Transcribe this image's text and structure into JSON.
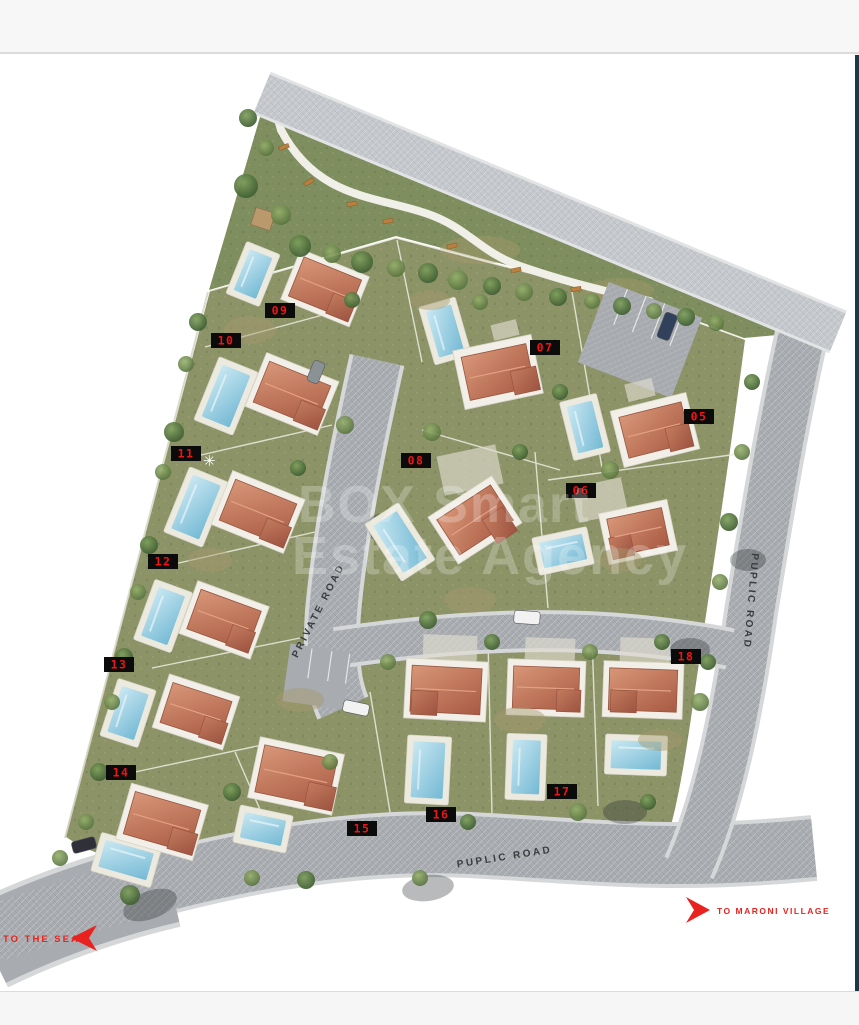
{
  "window": {
    "top_bar_color": "#f7f7f7",
    "bottom_bar_color": "#f6f6f6",
    "right_strip_color": "#143a4e",
    "canvas_color": "#ffffff"
  },
  "site_plan": {
    "watermark": {
      "line1": "BOX Smart",
      "line2": "Estate Agency"
    },
    "sun_symbol": "✳",
    "roads": [
      {
        "id": "private",
        "label": "PRIVATE ROAD"
      },
      {
        "id": "public-right",
        "label": "PUPLIC ROAD"
      },
      {
        "id": "public-bottom",
        "label": "PUPLIC ROAD"
      }
    ],
    "directions": [
      {
        "id": "to-sea",
        "label": "TO THE SEA",
        "arrow": "left"
      },
      {
        "id": "to-maroni",
        "label": "TO MARONI VILLAGE",
        "arrow": "right"
      }
    ],
    "plots": [
      {
        "number": "05"
      },
      {
        "number": "06"
      },
      {
        "number": "07"
      },
      {
        "number": "08"
      },
      {
        "number": "09"
      },
      {
        "number": "10"
      },
      {
        "number": "11"
      },
      {
        "number": "12"
      },
      {
        "number": "13"
      },
      {
        "number": "14"
      },
      {
        "number": "15"
      },
      {
        "number": "16"
      },
      {
        "number": "17"
      },
      {
        "number": "18"
      }
    ],
    "colors": {
      "plot_label_bg": "#0b0b0b",
      "plot_label_text": "#f21414",
      "direction_text": "#e8231f",
      "road_fill": "#a8abaf",
      "park_green": "#7f8e5e",
      "garden_green": "#8c9367",
      "roof_terracotta": "#bf7a5f",
      "pool_blue": "#8ecade"
    }
  }
}
